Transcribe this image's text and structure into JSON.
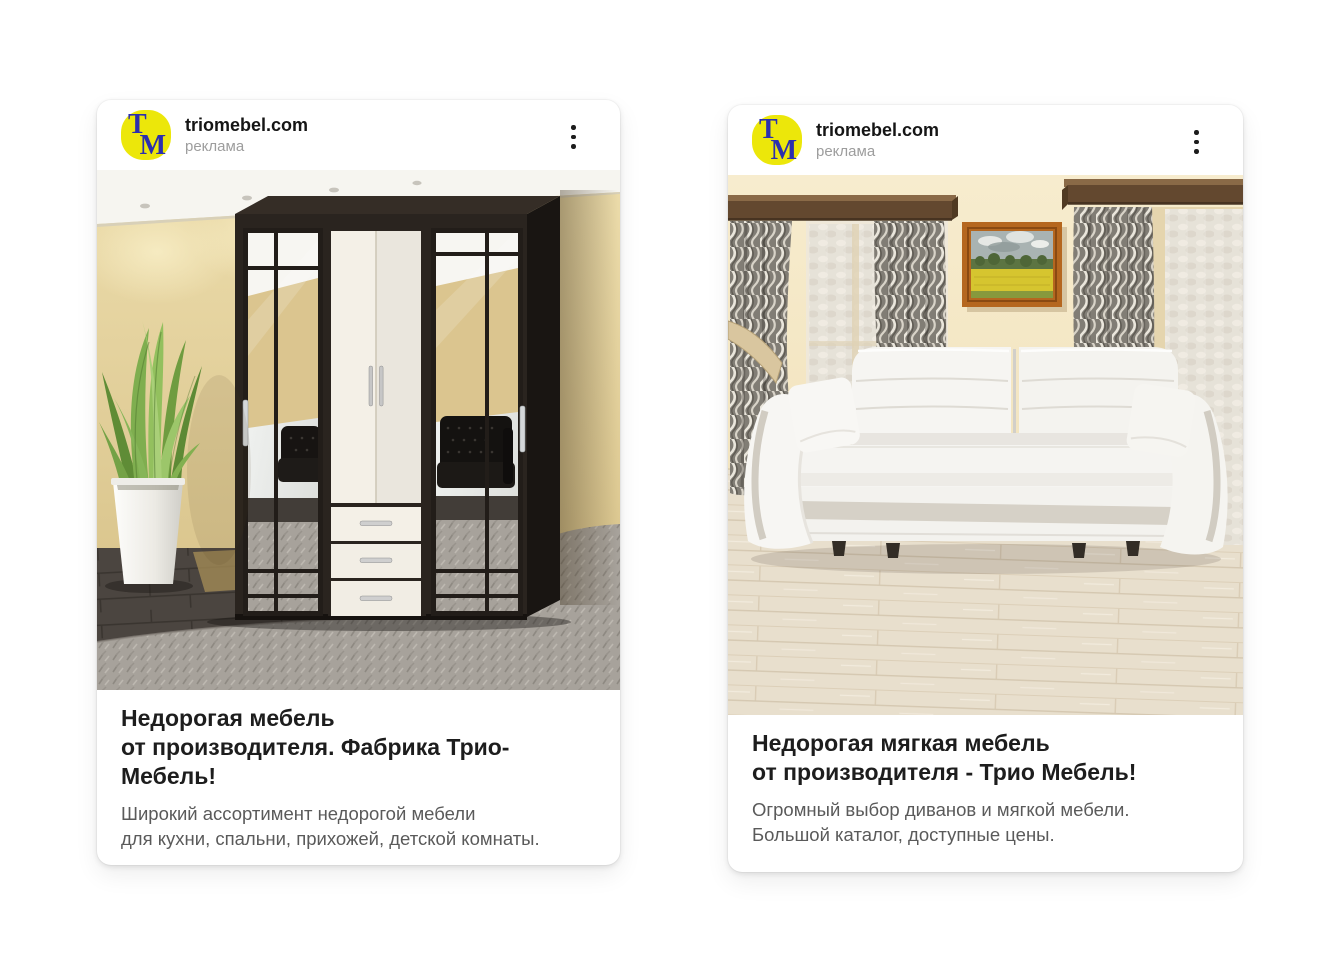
{
  "colors": {
    "page_background": "#ffffff",
    "logo_background": "#ece70a",
    "logo_letters": "#2b2fae",
    "headline_text": "#1d1d1d",
    "description_text": "#5a5a5a",
    "ad_label_text": "#9d9d9d"
  },
  "cards": [
    {
      "site": "triomebel.com",
      "ad_label": "реклама",
      "logo": {
        "t": "Т",
        "m": "М"
      },
      "image": "wardrobe-living-room-photo",
      "headline": "Недорогая мебель\nот производителя. Фабрика Трио-\nМебель!",
      "description": "Широкий ассортимент недорогой мебели\nдля кухни, спальни, прихожей, детской комнаты.",
      "menu_icon": "kebab-menu-icon"
    },
    {
      "site": "triomebel.com",
      "ad_label": "реклама",
      "logo": {
        "t": "Т",
        "m": "М"
      },
      "image": "white-sofa-living-room-photo",
      "headline": "Недорогая мягкая мебель\nот производителя - Трио Мебель!",
      "description": "Огромный выбор диванов и мягкой мебели.\nБольшой каталог, доступные цены.",
      "menu_icon": "kebab-menu-icon"
    }
  ]
}
